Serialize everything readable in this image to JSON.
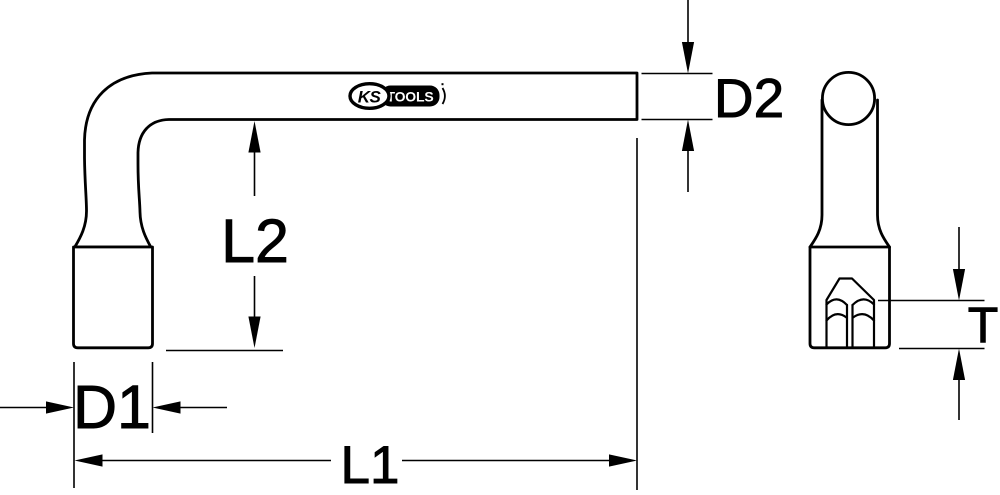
{
  "figure": {
    "logo": {
      "ks": "KS",
      "tools": "TOOLS"
    },
    "dimensions": {
      "d2": "D2",
      "l2": "L2",
      "d1": "D1",
      "l1": "L1",
      "t": "T"
    },
    "colors": {
      "line": "#000000",
      "background": "#ffffff",
      "logo_box": "#000000",
      "logo_text": "#ffffff"
    }
  }
}
